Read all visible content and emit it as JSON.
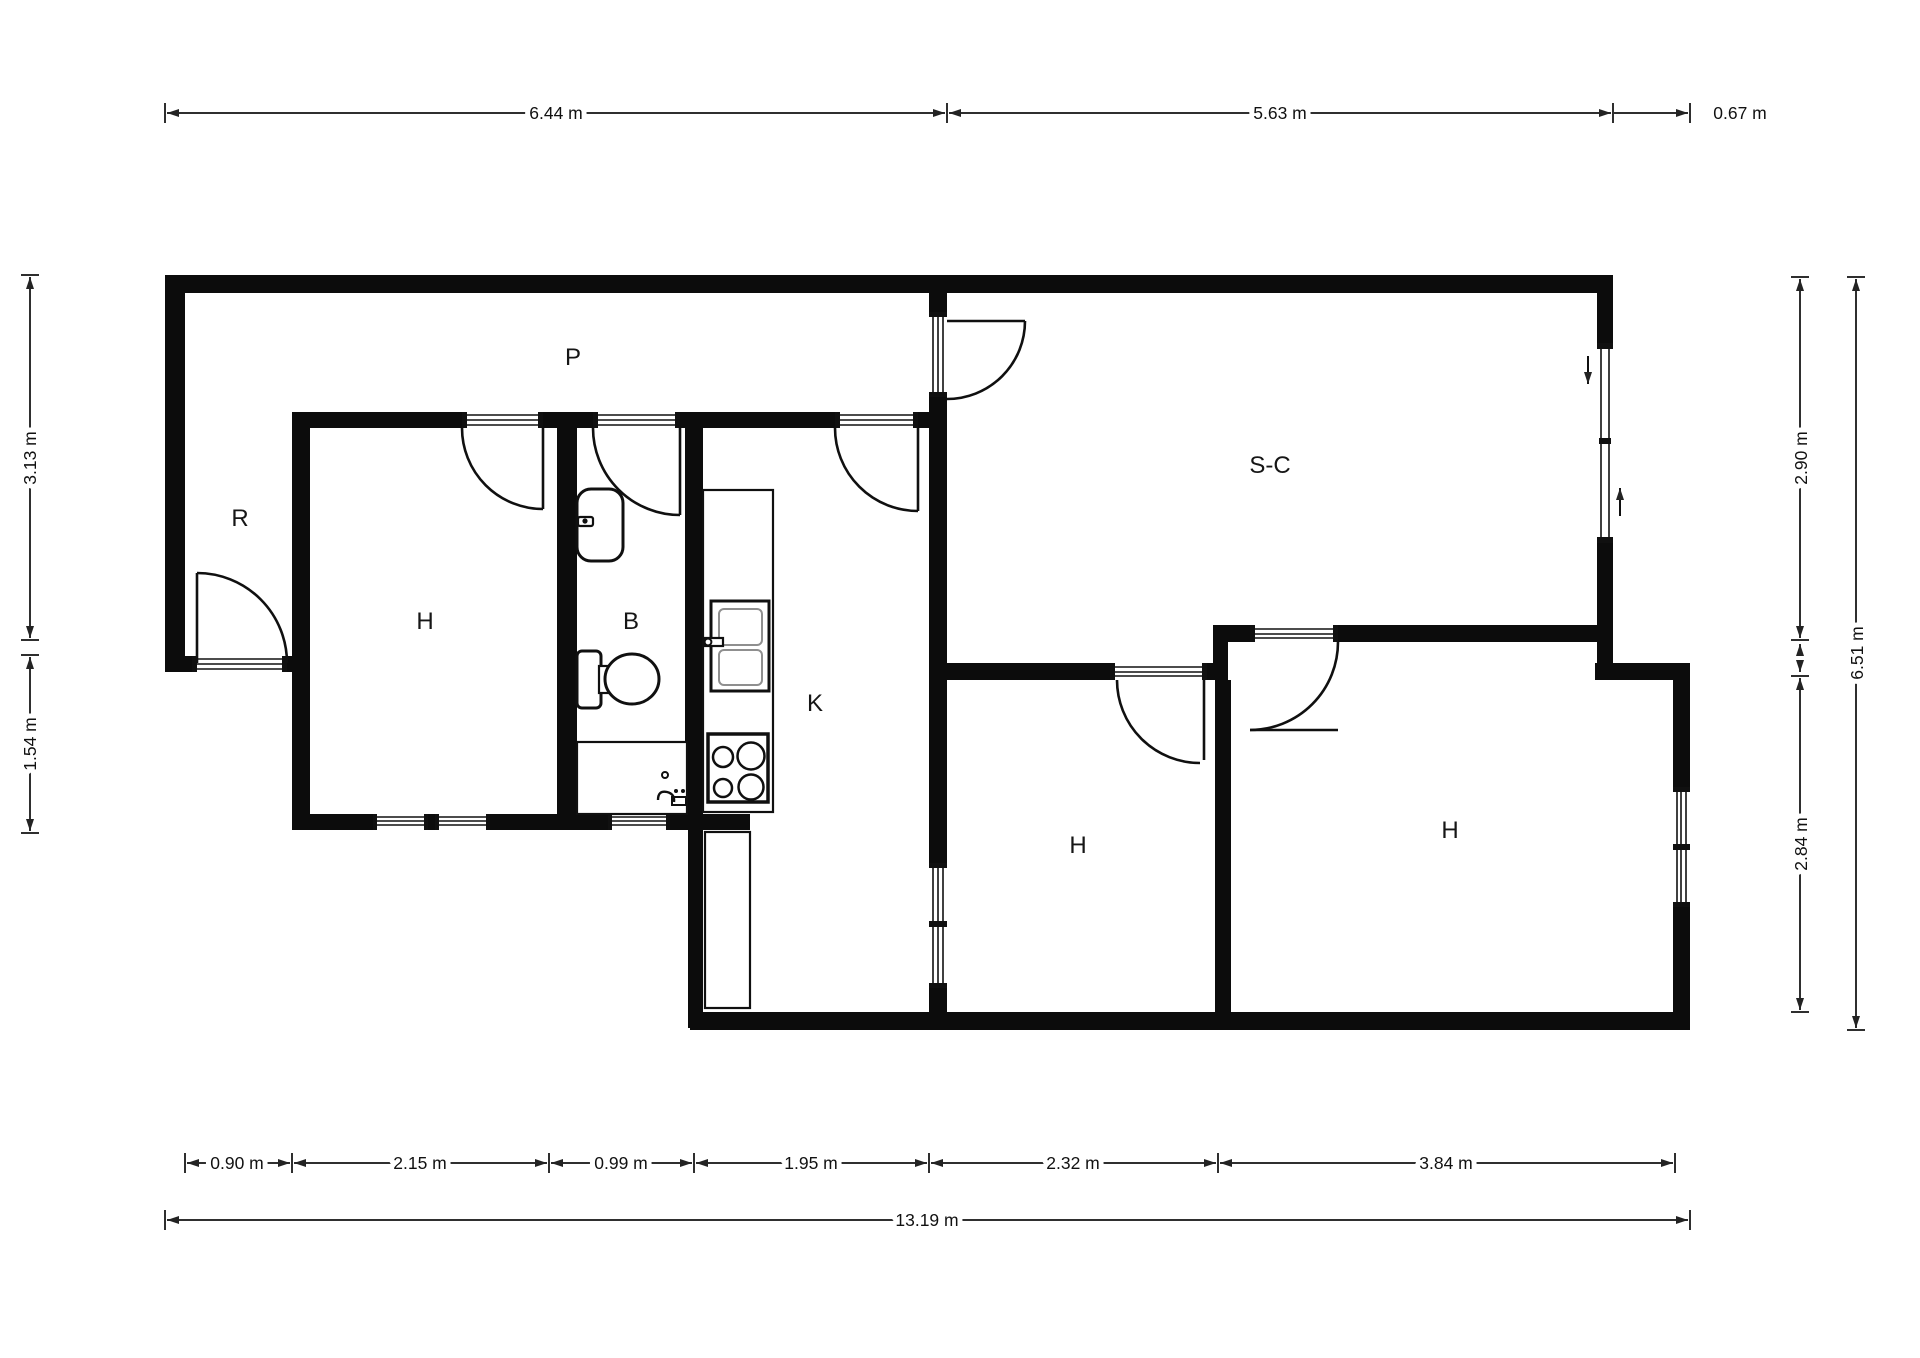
{
  "plan": {
    "type": "floor-plan",
    "rooms": [
      {
        "id": "hallway",
        "label": "P"
      },
      {
        "id": "entry",
        "label": "R"
      },
      {
        "id": "bedroom-left",
        "label": "H"
      },
      {
        "id": "bathroom",
        "label": "B"
      },
      {
        "id": "kitchen",
        "label": "K"
      },
      {
        "id": "living-dining",
        "label": "S-C"
      },
      {
        "id": "bedroom-middle",
        "label": "H"
      },
      {
        "id": "bedroom-right",
        "label": "H"
      }
    ],
    "dimensions": {
      "top": [
        {
          "label": "6.44 m"
        },
        {
          "label": "5.63 m"
        },
        {
          "label": "0.67 m"
        }
      ],
      "bottom": [
        {
          "label": "0.90 m"
        },
        {
          "label": "2.15 m"
        },
        {
          "label": "0.99 m"
        },
        {
          "label": "1.95 m"
        },
        {
          "label": "2.32 m"
        },
        {
          "label": "3.84 m"
        }
      ],
      "bottom_total": {
        "label": "13.19 m"
      },
      "left": [
        {
          "label": "3.13 m"
        },
        {
          "label": "1.54 m"
        }
      ],
      "right": [
        {
          "label": "2.90 m"
        },
        {
          "label": "2.84 m"
        }
      ],
      "right_total": {
        "label": "6.51 m"
      }
    },
    "fixtures": [
      "washbasin",
      "toilet",
      "shower",
      "kitchen-counter",
      "kitchen-sink",
      "stove",
      "fridge"
    ],
    "colors": {
      "wall": "#0c0c0c",
      "line": "#2f2f2f",
      "background": "#ffffff"
    }
  }
}
